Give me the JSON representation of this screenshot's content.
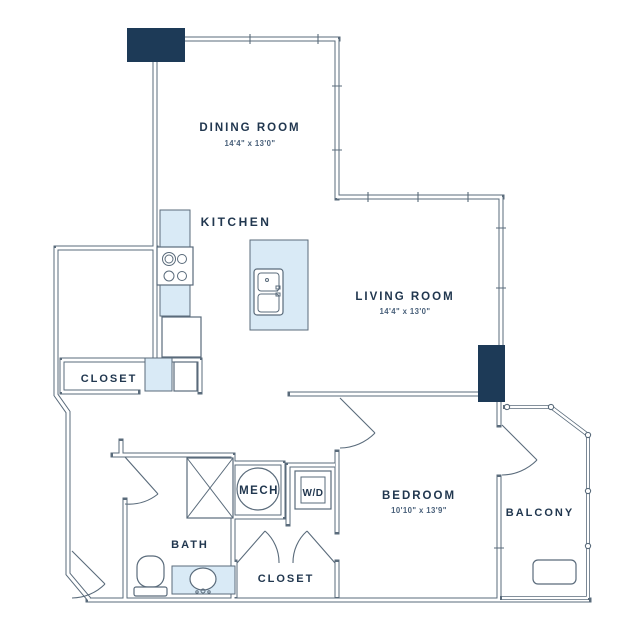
{
  "rooms": {
    "dining": {
      "label": "DINING ROOM",
      "dims": "14'4\" x 13'0\""
    },
    "kitchen": {
      "label": "KITCHEN"
    },
    "living": {
      "label": "LIVING ROOM",
      "dims": "14'4\" x 13'0\""
    },
    "entry_closet": {
      "label": "CLOSET"
    },
    "bath": {
      "label": "BATH"
    },
    "mech": {
      "label": "MECH"
    },
    "laundry": {
      "label": "W/D"
    },
    "bedroom_closet": {
      "label": "CLOSET"
    },
    "bedroom": {
      "label": "BEDROOM",
      "dims": "10'10\" x 13'9\""
    },
    "balcony": {
      "label": "BALCONY"
    }
  },
  "icons": [
    "stove-icon",
    "refrigerator-icon",
    "kitchen-island-sink-icon",
    "shower-icon",
    "water-heater-icon",
    "washer-dryer-icon",
    "toilet-icon",
    "vanity-sink-icon",
    "balcony-equipment-icon",
    "door-swing-icon",
    "window-wall-icon",
    "structural-column"
  ],
  "colors": {
    "background": "#ffffff",
    "wall_line": "#5a6b7b",
    "fixture_fill_blue": "#d9eaf6",
    "column_navy": "#1d3a57",
    "label_text": "#21374f",
    "dims_text": "#49607a"
  }
}
